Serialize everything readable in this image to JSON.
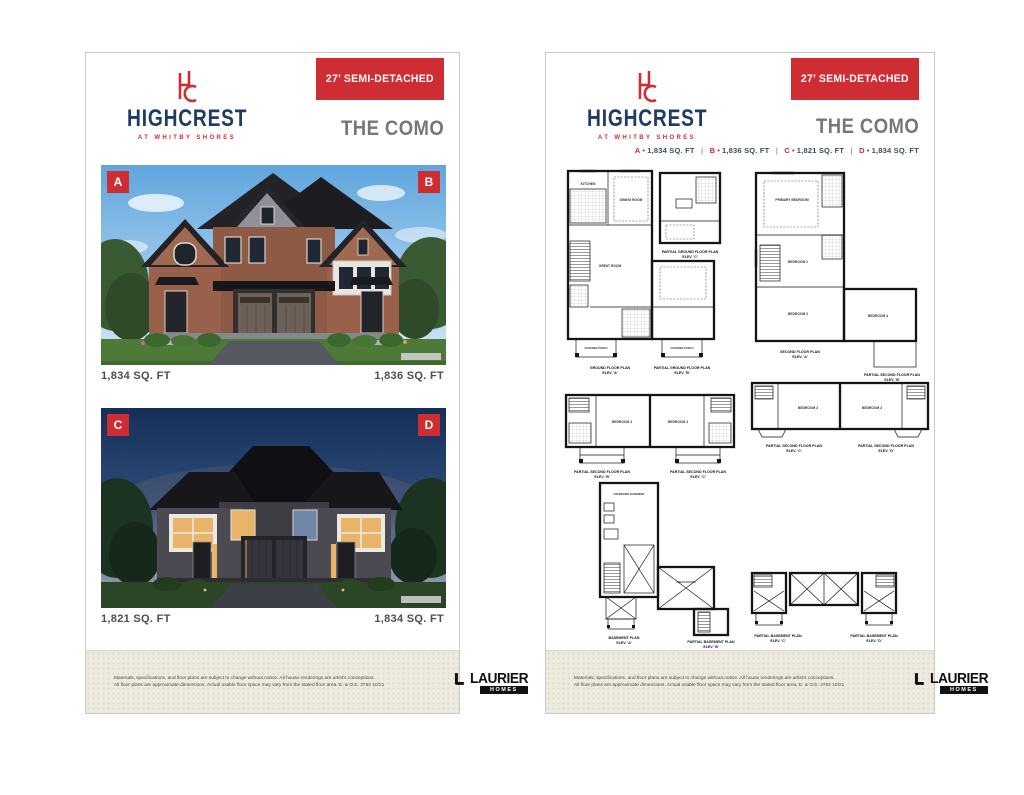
{
  "brand": {
    "monogram": "HC",
    "name": "HIGHCREST",
    "tagline": "AT WHITBY SHORES",
    "builder": "LAURIER",
    "builder_sub": "HOMES"
  },
  "banner": "27’ SEMI-DETACHED",
  "model": "THE COMO",
  "colors": {
    "accent_red": "#cf2d34",
    "brand_navy": "#1f3a64",
    "title_gray": "#76777a",
    "footer_beige": "#edebe0",
    "plan_ink": "#141414"
  },
  "left_page": {
    "photos": [
      {
        "badge_left": "A",
        "badge_right": "B",
        "sqft_left": "1,834 SQ. FT",
        "sqft_right": "1,836 SQ. FT"
      },
      {
        "badge_left": "C",
        "badge_right": "D",
        "sqft_left": "1,821 SQ. FT",
        "sqft_right": "1,834 SQ. FT"
      }
    ]
  },
  "right_page": {
    "bullet": "•",
    "sep": "|",
    "sqft_line": [
      {
        "unit": "A",
        "sqft": "1,834 SQ. FT"
      },
      {
        "unit": "B",
        "sqft": "1,836 SQ. FT"
      },
      {
        "unit": "C",
        "sqft": "1,821 SQ. FT"
      },
      {
        "unit": "D",
        "sqft": "1,834 SQ. FT"
      }
    ],
    "plans": {
      "labels": {
        "kitchen": "KITCHEN",
        "dining": "DINING ROOM",
        "great": "GREAT ROOM",
        "porch": "COVERED PORCH",
        "primary": "PRIMARY BEDROOM",
        "bed2": "BEDROOM 2",
        "bed3": "BEDROOM 3",
        "bed4": "BEDROOM 4",
        "unfinished": "UNFINISHED BASEMENT",
        "unexcavated": "UNEXCAVATED"
      },
      "captions": [
        {
          "t": "GROUND FLOOR PLAN",
          "e": "ELEV. 'A'"
        },
        {
          "t": "PARTIAL GROUND FLOOR PLAN",
          "e": "ELEV. 'B'"
        },
        {
          "t": "PARTIAL GROUND FLOOR PLAN",
          "e": "ELEV. 'C'"
        },
        {
          "t": "SECOND FLOOR PLAN",
          "e": "ELEV. 'A'"
        },
        {
          "t": "PARTIAL SECOND FLOOR PLAN",
          "e": "ELEV. 'B'"
        },
        {
          "t": "PARTIAL SECOND FLOOR PLAN",
          "e": "ELEV. 'B'"
        },
        {
          "t": "PARTIAL SECOND FLOOR PLAN",
          "e": "ELEV. 'C'"
        },
        {
          "t": "PARTIAL SECOND FLOOR PLAN",
          "e": "ELEV. 'C'"
        },
        {
          "t": "PARTIAL SECOND FLOOR PLAN",
          "e": "ELEV. 'D'"
        },
        {
          "t": "BASEMENT PLAN",
          "e": "ELEV. 'A'"
        },
        {
          "t": "PARTIAL BASEMENT PLAN",
          "e": "ELEV. 'B'"
        },
        {
          "t": "PARTIAL BASEMENT PLAN",
          "e": "ELEV. 'C'"
        },
        {
          "t": "PARTIAL BASEMENT PLAN",
          "e": "ELEV. 'D'"
        }
      ]
    }
  },
  "footer": {
    "disclaimer_line1": "Materials, specifications, and floor plans are subject to change without notice. All house renderings are artist's conceptions.",
    "disclaimer_line2": "All floor plans are approximate dimensions. Actual usable floor space may vary from the stated floor area. E. & O.E. 3762 10/21"
  }
}
